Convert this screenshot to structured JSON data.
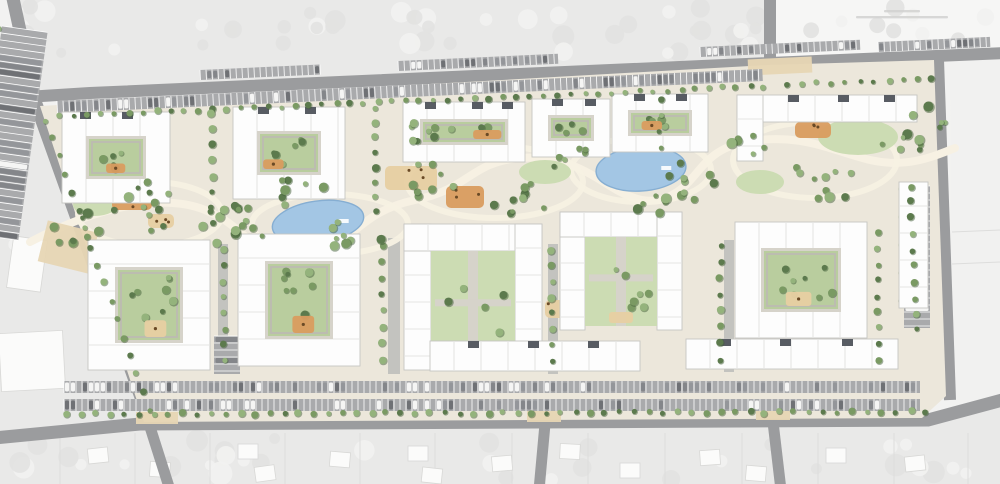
{
  "meta": {
    "type": "architectural-site-plan",
    "visible_text": "none-legible"
  },
  "palette": {
    "canvas": "#f2f2f1",
    "context": "#e9e9e8",
    "contextRight": "#f1f1f0",
    "contextTopRight": "#f6f6f5",
    "blobLight": "#f2f2f1",
    "blobDark": "#e2e2e1",
    "road": "#9b9c9e",
    "parking": "#a9aaac",
    "stall": "#ffffff",
    "site": "#ece7db",
    "path": "#f7f1e3",
    "drive": "#bcbcba",
    "pave": "#d6d3ca",
    "innerPath": "#bdbab2",
    "lawn": "#b9cd9e",
    "lawnLight": "#ccdcb3",
    "tree": "#7a9a63",
    "treeDark": "#5c7a4d",
    "treeLight": "#94b37c",
    "treeShadow": "#44603a",
    "pond": "#a3c6e4",
    "pondEdge": "#86aed2",
    "sand": "#e7cfa2",
    "play": "#d99c5f",
    "equip": "#6a4a26",
    "plaza": "#e7d6b4",
    "bld": "#fdfdfd",
    "bldEdge": "#c6c6c3",
    "roofSeam": "#dcdcda",
    "roofDark": "#585c63",
    "house": "#fbfbfa",
    "houseEdge": "#d8d8d6",
    "parcel": "#dddddc",
    "captionBar": "#cfcfce",
    "carColors": [
      "#84868a",
      "#94969a",
      "#f5f5f4",
      "#6f7175"
    ]
  },
  "context": {
    "areas": [
      {
        "path": "M -6 -6 H 1006 V 52 L 768 65 L 90 93 L 36 100 L 12 -6 Z",
        "fill": "context"
      },
      {
        "path": "M -6 110 L 38 110 L 148 420 L -6 438 Z",
        "fill": "context"
      },
      {
        "path": "M -6 442 L 140 428 L 928 424 L 1006 403 L 1006 490 L -6 490 Z",
        "fill": "context"
      },
      {
        "path": "M 950 60 L 1006 56 L 1006 400 L 952 400 Z",
        "fill": "contextRight"
      },
      {
        "path": "M 776 -6 L 1006 -6 L 1006 52 L 776 58 Z",
        "fill": "contextTopRight"
      }
    ],
    "blob_fields": [
      {
        "seed": 7,
        "x": 15,
        "y": 2,
        "w": 745,
        "h": 52,
        "n": 46,
        "rmin": 5,
        "rmax": 12
      },
      {
        "seed": 11,
        "x": 785,
        "y": 4,
        "w": 205,
        "h": 44,
        "n": 9,
        "rmin": 5,
        "rmax": 10
      },
      {
        "seed": 23,
        "x": 15,
        "y": 438,
        "w": 965,
        "h": 42,
        "n": 34,
        "rmin": 5,
        "rmax": 12
      },
      {
        "seed": 31,
        "x": 2,
        "y": 115,
        "w": 30,
        "h": 180,
        "n": 6,
        "rmin": 4,
        "rmax": 8
      }
    ],
    "white_patches": [
      {
        "x": 0,
        "y": 332,
        "w": 64,
        "h": 58,
        "rot": -3
      },
      {
        "x": 10,
        "y": 238,
        "w": 34,
        "h": 52,
        "rot": 8
      }
    ],
    "parcel_lines_x": [
      60,
      135,
      210,
      285,
      360,
      435,
      512,
      588,
      665,
      742,
      818,
      894,
      968
    ],
    "parcel_y1": 433,
    "parcel_y2": 484,
    "houses": [
      {
        "x": 88,
        "y": 448,
        "rot": -6
      },
      {
        "x": 150,
        "y": 462,
        "rot": 4
      },
      {
        "x": 238,
        "y": 444,
        "rot": 0
      },
      {
        "x": 255,
        "y": 466,
        "rot": -8
      },
      {
        "x": 330,
        "y": 452,
        "rot": 5
      },
      {
        "x": 408,
        "y": 446,
        "rot": 0
      },
      {
        "x": 422,
        "y": 468,
        "rot": 6
      },
      {
        "x": 492,
        "y": 456,
        "rot": -5
      },
      {
        "x": 560,
        "y": 444,
        "rot": 3
      },
      {
        "x": 620,
        "y": 463,
        "rot": 0
      },
      {
        "x": 700,
        "y": 450,
        "rot": -4
      },
      {
        "x": 746,
        "y": 466,
        "rot": 5
      },
      {
        "x": 826,
        "y": 448,
        "rot": 0
      },
      {
        "x": 905,
        "y": 456,
        "rot": -6
      }
    ],
    "right_lines": [
      {
        "x1": 952,
        "y1": 232,
        "x2": 1000,
        "y2": 230
      },
      {
        "x1": 952,
        "y1": 264,
        "x2": 1000,
        "y2": 262
      }
    ],
    "caption_bars": [
      {
        "x": 884,
        "y": 10,
        "w": 36,
        "h": 2.4
      },
      {
        "x": 856,
        "y": 16,
        "w": 92,
        "h": 2.4
      }
    ]
  },
  "roads": [
    {
      "d": "M 12 -6 L 36 104 L 152 428",
      "w": 13
    },
    {
      "d": "M -6 99 L 90 93 L 770 63 L 1006 53",
      "w": 12
    },
    {
      "d": "M 770 -6 L 770 68",
      "w": 12
    },
    {
      "d": "M -6 438 L 140 424 L 928 420 L 1006 399",
      "w": 13
    },
    {
      "d": "M 150 427 L 170 490",
      "w": 11
    },
    {
      "d": "M 545 424 L 539 490",
      "w": 11
    },
    {
      "d": "M 773 422 L 781 490",
      "w": 11
    },
    {
      "d": "M 938 60 L 950 400",
      "w": 12
    }
  ],
  "site": {
    "outline": "M 40 106 L 768 65 L 934 60 L 946 396 L 922 418 L 144 422 Z"
  },
  "parking": [
    {
      "x": 57,
      "y": 101,
      "w": 706,
      "h": 12,
      "rot": -2.6,
      "stall": 6,
      "cars": 0.5,
      "trees": false,
      "seed": 3
    },
    {
      "x": 200,
      "y": 70,
      "w": 120,
      "h": 10,
      "rot": -2.6,
      "stall": 6,
      "cars": 0.35,
      "seed": 4
    },
    {
      "x": 398,
      "y": 61,
      "w": 160,
      "h": 10,
      "rot": -2.6,
      "stall": 6,
      "cars": 0.35,
      "seed": 5
    },
    {
      "x": 700,
      "y": 47,
      "w": 160,
      "h": 10,
      "rot": -2.6,
      "stall": 6,
      "cars": 0.35,
      "seed": 6
    },
    {
      "x": 878,
      "y": 42,
      "w": 112,
      "h": 10,
      "rot": -2.6,
      "stall": 6,
      "cars": 0.3,
      "seed": 7
    },
    {
      "x": 64,
      "y": 381,
      "w": 856,
      "h": 12,
      "rot": 0,
      "stall": 6,
      "cars": 0.45,
      "seed": 8
    },
    {
      "x": 64,
      "y": 399,
      "w": 856,
      "h": 12,
      "rot": 0,
      "stall": 6,
      "cars": 0.35,
      "seed": 9
    },
    {
      "x": 2,
      "y": 26,
      "w": 46,
      "h": 210,
      "rot": 8,
      "stall": 7,
      "cars": 0.5,
      "vert": true,
      "trees": true,
      "seed": 10
    },
    {
      "x": 904,
      "y": 186,
      "w": 26,
      "h": 142,
      "rot": 0,
      "stall": 7,
      "cars": 0.4,
      "vert": true,
      "trees": true,
      "seed": 11
    },
    {
      "x": 214,
      "y": 336,
      "w": 26,
      "h": 38,
      "rot": 0,
      "stall": 7,
      "cars": 0.5,
      "vert": true,
      "seed": 12
    }
  ],
  "park": {
    "spine": "M 30 242 C 110 200 170 196 205 210 C 250 228 240 252 300 252 C 355 252 350 214 415 200 C 470 189 470 162 520 158 C 560 155 585 170 610 186 C 640 205 660 205 680 190 C 700 175 705 150 745 142 C 800 132 830 150 870 160 C 905 168 930 158 955 148",
    "loops": [
      {
        "cx": 150,
        "cy": 214,
        "rx": 72,
        "ry": 32
      },
      {
        "cx": 330,
        "cy": 224,
        "rx": 78,
        "ry": 30
      },
      {
        "cx": 495,
        "cy": 182,
        "rx": 88,
        "ry": 36
      },
      {
        "cx": 641,
        "cy": 170,
        "rx": 70,
        "ry": 32
      },
      {
        "cx": 815,
        "cy": 160,
        "rx": 82,
        "ry": 38
      }
    ],
    "drives": [
      {
        "x": 388,
        "y": 238,
        "w": 12,
        "h": 136
      },
      {
        "x": 548,
        "y": 244,
        "w": 10,
        "h": 130
      },
      {
        "x": 724,
        "y": 240,
        "w": 10,
        "h": 132
      },
      {
        "x": 218,
        "y": 244,
        "w": 10,
        "h": 128
      }
    ],
    "lawns": [
      {
        "cx": 858,
        "cy": 137,
        "rx": 40,
        "ry": 18
      },
      {
        "cx": 545,
        "cy": 172,
        "rx": 26,
        "ry": 12
      },
      {
        "cx": 760,
        "cy": 182,
        "rx": 24,
        "ry": 12
      },
      {
        "cx": 95,
        "cy": 205,
        "rx": 22,
        "ry": 11
      }
    ]
  },
  "water": {
    "ponds": [
      {
        "cx": 318,
        "cy": 222,
        "rx": 46,
        "ry": 21,
        "rot": -8
      },
      {
        "cx": 641,
        "cy": 169,
        "rx": 45,
        "ry": 22,
        "rot": -4
      }
    ]
  },
  "playgrounds": [
    {
      "x": 112,
      "y": 188,
      "w": 40,
      "h": 22,
      "c": "play",
      "seed": 1
    },
    {
      "x": 148,
      "y": 214,
      "w": 26,
      "h": 14,
      "c": "sand",
      "seed": 2
    },
    {
      "x": 385,
      "y": 166,
      "w": 52,
      "h": 24,
      "c": "sand",
      "seed": 3
    },
    {
      "x": 446,
      "y": 186,
      "w": 38,
      "h": 22,
      "c": "play",
      "seed": 4
    },
    {
      "x": 620,
      "y": 118,
      "w": 30,
      "h": 16,
      "c": "play",
      "seed": 5
    },
    {
      "x": 795,
      "y": 122,
      "w": 36,
      "h": 16,
      "c": "play",
      "seed": 6
    },
    {
      "x": 545,
      "y": 300,
      "w": 34,
      "h": 18,
      "c": "sand",
      "seed": 7
    },
    {
      "x": 770,
      "y": 298,
      "w": 34,
      "h": 18,
      "c": "sand",
      "seed": 8
    }
  ],
  "plazas": [
    {
      "x": 748,
      "y": 58,
      "w": 64,
      "h": 16,
      "rot": -2.6
    },
    {
      "x": 136,
      "y": 412,
      "w": 42,
      "h": 12,
      "rot": 0
    },
    {
      "x": 527,
      "y": 410,
      "w": 34,
      "h": 12,
      "rot": 0
    },
    {
      "x": 756,
      "y": 408,
      "w": 34,
      "h": 12,
      "rot": 0
    },
    {
      "x": 42,
      "y": 226,
      "w": 52,
      "h": 42,
      "rot": 14
    }
  ],
  "buildings": [
    {
      "kind": "donut",
      "x": 62,
      "y": 112,
      "w": 108,
      "h": 91,
      "t": 24,
      "play": true,
      "notches": [
        80,
        122
      ],
      "seed": 21
    },
    {
      "kind": "donut",
      "x": 233,
      "y": 107,
      "w": 112,
      "h": 92,
      "t": 24,
      "play": true,
      "notches": [
        258,
        305
      ],
      "seed": 22
    },
    {
      "kind": "donut",
      "x": 403,
      "y": 102,
      "w": 122,
      "h": 60,
      "t": 17,
      "play": true,
      "notches": [
        425,
        472,
        502
      ],
      "seed": 23
    },
    {
      "kind": "donut",
      "x": 532,
      "y": 99,
      "w": 78,
      "h": 58,
      "t": 16,
      "play": false,
      "notches": [
        552,
        585
      ],
      "seed": 24
    },
    {
      "kind": "donut",
      "x": 612,
      "y": 94,
      "w": 96,
      "h": 58,
      "t": 16,
      "play": true,
      "notches": [
        634,
        676
      ],
      "seed": 25
    },
    {
      "kind": "slab",
      "x": 737,
      "y": 95,
      "w": 180,
      "h": 27,
      "notches": [
        788,
        838,
        884
      ],
      "seed": 26
    },
    {
      "kind": "slab",
      "x": 737,
      "y": 95,
      "w": 26,
      "h": 66,
      "seed": 27
    },
    {
      "kind": "donut",
      "x": 88,
      "y": 240,
      "w": 122,
      "h": 130,
      "t": 27,
      "play": true,
      "seed": 28
    },
    {
      "kind": "donut",
      "x": 238,
      "y": 234,
      "w": 122,
      "h": 132,
      "t": 27,
      "play": true,
      "seed": 29
    },
    {
      "kind": "u",
      "x": 404,
      "y": 224,
      "w": 138,
      "h": 146,
      "t": 27,
      "seed": 30
    },
    {
      "kind": "u",
      "x": 560,
      "y": 212,
      "w": 122,
      "h": 118,
      "t": 25,
      "seed": 31
    },
    {
      "kind": "donut",
      "x": 735,
      "y": 222,
      "w": 132,
      "h": 116,
      "t": 26,
      "play": true,
      "seed": 32
    },
    {
      "kind": "slab",
      "x": 899,
      "y": 182,
      "w": 29,
      "h": 126,
      "seed": 33
    },
    {
      "kind": "slab",
      "x": 430,
      "y": 341,
      "w": 210,
      "h": 30,
      "notches": [
        468,
        528,
        588
      ],
      "seed": 34
    },
    {
      "kind": "slab",
      "x": 686,
      "y": 339,
      "w": 212,
      "h": 30,
      "notches": [
        720,
        780,
        842
      ],
      "seed": 35
    }
  ],
  "trees": {
    "rows": [
      {
        "x1": 60,
        "y1": 116,
        "x2": 764,
        "y2": 86,
        "n": 52,
        "r": 3.0
      },
      {
        "x1": 788,
        "y1": 84,
        "x2": 932,
        "y2": 80,
        "n": 11,
        "r": 3.0
      },
      {
        "x1": 66,
        "y1": 414,
        "x2": 925,
        "y2": 412,
        "n": 60,
        "r": 3.2
      },
      {
        "x1": 46,
        "y1": 120,
        "x2": 150,
        "y2": 410,
        "n": 17,
        "r": 3.2
      },
      {
        "x1": 910,
        "y1": 186,
        "x2": 916,
        "y2": 330,
        "n": 10,
        "r": 3.2
      },
      {
        "x1": 212,
        "y1": 114,
        "x2": 212,
        "y2": 222,
        "n": 8,
        "r": 3.5
      },
      {
        "x1": 376,
        "y1": 108,
        "x2": 376,
        "y2": 212,
        "n": 8,
        "r": 3.5
      },
      {
        "x1": 660,
        "y1": 100,
        "x2": 660,
        "y2": 148,
        "n": 4,
        "r": 3.2
      },
      {
        "x1": 224,
        "y1": 250,
        "x2": 224,
        "y2": 360,
        "n": 8,
        "r": 3.5
      },
      {
        "x1": 382,
        "y1": 245,
        "x2": 382,
        "y2": 360,
        "n": 8,
        "r": 3.5
      },
      {
        "x1": 552,
        "y1": 250,
        "x2": 552,
        "y2": 360,
        "n": 8,
        "r": 3.5
      },
      {
        "x1": 720,
        "y1": 245,
        "x2": 720,
        "y2": 360,
        "n": 8,
        "r": 3.5
      },
      {
        "x1": 878,
        "y1": 232,
        "x2": 878,
        "y2": 360,
        "n": 9,
        "r": 3.5
      }
    ],
    "clusters": [
      {
        "cx": 75,
        "cy": 225,
        "r": 30,
        "n": 9,
        "seed": 41
      },
      {
        "cx": 150,
        "cy": 208,
        "r": 40,
        "n": 12,
        "seed": 42
      },
      {
        "cx": 235,
        "cy": 228,
        "r": 34,
        "n": 10,
        "seed": 43
      },
      {
        "cx": 300,
        "cy": 190,
        "r": 26,
        "n": 7,
        "seed": 44
      },
      {
        "cx": 355,
        "cy": 235,
        "r": 28,
        "n": 8,
        "seed": 45
      },
      {
        "cx": 430,
        "cy": 180,
        "r": 26,
        "n": 8,
        "seed": 46
      },
      {
        "cx": 520,
        "cy": 205,
        "r": 32,
        "n": 9,
        "seed": 47
      },
      {
        "cx": 575,
        "cy": 163,
        "r": 24,
        "n": 6,
        "seed": 48
      },
      {
        "cx": 700,
        "cy": 182,
        "r": 34,
        "n": 9,
        "seed": 49
      },
      {
        "cx": 745,
        "cy": 140,
        "r": 22,
        "n": 6,
        "seed": 50
      },
      {
        "cx": 820,
        "cy": 185,
        "r": 36,
        "n": 10,
        "seed": 51
      },
      {
        "cx": 900,
        "cy": 148,
        "r": 26,
        "n": 7,
        "seed": 52
      },
      {
        "cx": 930,
        "cy": 118,
        "r": 18,
        "n": 5,
        "seed": 53
      },
      {
        "cx": 418,
        "cy": 132,
        "r": 16,
        "n": 5,
        "seed": 54
      },
      {
        "cx": 240,
        "cy": 206,
        "r": 18,
        "n": 5,
        "seed": 55
      },
      {
        "cx": 652,
        "cy": 205,
        "r": 20,
        "n": 6,
        "seed": 56
      }
    ]
  }
}
